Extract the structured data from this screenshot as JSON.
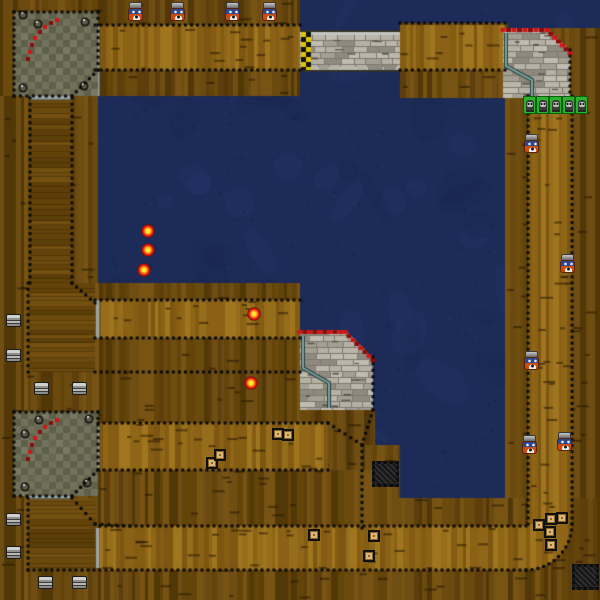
{
  "canvas": {
    "width": 600,
    "height": 600
  },
  "palette": {
    "water_base": "#1d2b58",
    "water_light": "#2c3e74",
    "water_dark": "#16224a",
    "water_speckle": "#121c3c",
    "wood_outer": [
      "#6b4a10",
      "#5e3f0b",
      "#775414",
      "#523807",
      "#6f4e13",
      "#634409"
    ],
    "wood_lane": [
      "#8a6115",
      "#966d1b",
      "#7d5711",
      "#a0751f",
      "#8f6617",
      "#845c12"
    ],
    "wood_block": [
      "#6b4a0e",
      "#634309",
      "#734f10",
      "#5c3e08"
    ],
    "plank_seam": "rgba(35,22,4,0.55)",
    "checker_a": "#71725b",
    "checker_b": "#5f604a",
    "stone_shades": [
      "#b5b1a5",
      "#c0bcb0",
      "#a39f93",
      "#8e8a7f",
      "#bab6aa"
    ],
    "mortar": "#7d796e",
    "stone_dash": "#5a564c",
    "curb_red": "#d11616",
    "curb_dark": "#8c0c0c",
    "rail_teal": "#7fa09e",
    "rail_teal_dark": "#24403d",
    "rail_gray": "#c2c6c0",
    "rail_gray_dark": "#30302a",
    "gray_strip": "#9ba3a3",
    "gray_strip_edge": "#5f6a6a",
    "dotted": "#0b0b0b",
    "start_yellow": "#dfc400",
    "start_black": "#121212",
    "bolt_dark": "#17170f",
    "bolt_mid": "#5d5d4f",
    "bolt_light": "#d3d3c7"
  },
  "terrain": {
    "wood_outer": [
      [
        0,
        0,
        300,
        96
      ],
      [
        400,
        23,
        108,
        75
      ],
      [
        505,
        28,
        95,
        572
      ],
      [
        0,
        96,
        98,
        504
      ],
      [
        75,
        283,
        225,
        190
      ],
      [
        300,
        410,
        75,
        118
      ],
      [
        362,
        445,
        38,
        53
      ],
      [
        98,
        470,
        300,
        130
      ],
      [
        398,
        498,
        202,
        102
      ]
    ],
    "lanes": [
      [
        95,
        25,
        205,
        45
      ],
      [
        400,
        25,
        105,
        45
      ],
      [
        528,
        96,
        44,
        434
      ],
      [
        100,
        526,
        428,
        44
      ],
      [
        95,
        300,
        205,
        38
      ],
      [
        98,
        423,
        230,
        47
      ]
    ],
    "corner_disc": {
      "cx": 526,
      "cy": 524,
      "r": 46
    },
    "blocks_h": [
      [
        30,
        98,
        42,
        185
      ],
      [
        28,
        283,
        67,
        89
      ],
      [
        28,
        498,
        67,
        70
      ]
    ],
    "gray_strips": [
      [
        95,
        24,
        5,
        72
      ],
      [
        30,
        95,
        42,
        5
      ],
      [
        95,
        424,
        5,
        44
      ],
      [
        28,
        495,
        44,
        4
      ],
      [
        96,
        528,
        4,
        40
      ],
      [
        96,
        300,
        4,
        38
      ]
    ],
    "dotted": [
      [
        95,
        25,
        300,
        25
      ],
      [
        400,
        23,
        505,
        23
      ],
      [
        95,
        70,
        300,
        70
      ],
      [
        400,
        70,
        505,
        70
      ],
      [
        528,
        96,
        528,
        524
      ],
      [
        572,
        96,
        572,
        524
      ],
      [
        100,
        526,
        526,
        526
      ],
      [
        28,
        570,
        526,
        570
      ],
      [
        95,
        300,
        300,
        300
      ],
      [
        95,
        338,
        300,
        338
      ],
      [
        95,
        372,
        300,
        372
      ],
      [
        98,
        423,
        328,
        423
      ],
      [
        98,
        470,
        328,
        470
      ],
      [
        328,
        423,
        362,
        445
      ],
      [
        362,
        445,
        362,
        528
      ],
      [
        373,
        410,
        362,
        445
      ],
      [
        373,
        357,
        373,
        410
      ],
      [
        570,
        50,
        570,
        98
      ],
      [
        30,
        98,
        30,
        283
      ],
      [
        72,
        98,
        72,
        283
      ],
      [
        28,
        283,
        28,
        372
      ],
      [
        72,
        283,
        95,
        303
      ],
      [
        28,
        498,
        28,
        570
      ],
      [
        72,
        498,
        95,
        524
      ],
      [
        95,
        524,
        130,
        526
      ],
      [
        14,
        12,
        98,
        12
      ],
      [
        98,
        12,
        98,
        70
      ],
      [
        98,
        70,
        72,
        96
      ],
      [
        14,
        96,
        72,
        96
      ],
      [
        14,
        12,
        14,
        96
      ],
      [
        14,
        412,
        98,
        412
      ],
      [
        98,
        412,
        98,
        470
      ],
      [
        98,
        470,
        72,
        496
      ],
      [
        14,
        496,
        72,
        496
      ],
      [
        14,
        412,
        14,
        496
      ]
    ],
    "arcs": [
      [
        526,
        524,
        46,
        0,
        90
      ]
    ],
    "pits": [
      {
        "x": 14,
        "y": 12,
        "size": 84,
        "bolts": [
          [
            23,
            15
          ],
          [
            38,
            24
          ],
          [
            85,
            22
          ],
          [
            23,
            88
          ],
          [
            84,
            86
          ]
        ],
        "curb": [
          [
            55,
            18
          ],
          [
            49,
            21
          ],
          [
            43,
            25
          ],
          [
            38,
            30
          ],
          [
            33,
            36
          ],
          [
            30,
            43
          ],
          [
            28,
            50
          ],
          [
            26,
            57
          ]
        ]
      },
      {
        "x": 14,
        "y": 412,
        "size": 84,
        "bolts": [
          [
            39,
            420
          ],
          [
            25,
            434
          ],
          [
            89,
            419
          ],
          [
            25,
            487
          ],
          [
            87,
            483
          ]
        ],
        "curb": [
          [
            55,
            418
          ],
          [
            49,
            421
          ],
          [
            43,
            425
          ],
          [
            38,
            430
          ],
          [
            33,
            436
          ],
          [
            30,
            443
          ],
          [
            28,
            450
          ],
          [
            26,
            457
          ]
        ]
      }
    ],
    "platforms": [
      {
        "poly": [
          [
            503,
            28
          ],
          [
            547,
            28
          ],
          [
            570,
            51
          ],
          [
            570,
            98
          ],
          [
            503,
            98
          ]
        ],
        "curbs": [
          [
            503,
            28,
            547,
            28
          ],
          [
            547,
            28,
            570,
            51
          ]
        ],
        "rail": [
          [
            506,
            33
          ],
          [
            506,
            66
          ],
          [
            532,
            80
          ],
          [
            532,
            97
          ]
        ]
      },
      {
        "poly": [
          [
            300,
            330
          ],
          [
            345,
            330
          ],
          [
            373,
            358
          ],
          [
            373,
            410
          ],
          [
            300,
            410
          ]
        ],
        "curbs": [
          [
            300,
            330,
            345,
            330
          ],
          [
            345,
            330,
            373,
            358
          ]
        ],
        "rail": [
          [
            303,
            336
          ],
          [
            303,
            368
          ],
          [
            329,
            383
          ],
          [
            329,
            408
          ]
        ]
      }
    ],
    "bridge": {
      "x": 300,
      "y": 30,
      "w": 100,
      "h": 42,
      "start_line": {
        "x": 301,
        "w": 10,
        "cell": 5
      }
    }
  },
  "objects": [
    {
      "type": "spectator",
      "name": "spectator-sprite",
      "x": 128,
      "y": 2
    },
    {
      "type": "spectator",
      "name": "spectator-sprite",
      "x": 170,
      "y": 2
    },
    {
      "type": "spectator",
      "name": "spectator-sprite",
      "x": 225,
      "y": 2
    },
    {
      "type": "spectator",
      "name": "spectator-sprite",
      "x": 262,
      "y": 2
    },
    {
      "type": "spectator",
      "name": "spectator-sprite",
      "x": 524,
      "y": 134
    },
    {
      "type": "spectator",
      "name": "spectator-sprite",
      "x": 560,
      "y": 254
    },
    {
      "type": "spectator",
      "name": "spectator-sprite",
      "x": 524,
      "y": 351
    },
    {
      "type": "spectator",
      "name": "spectator-sprite",
      "x": 522,
      "y": 435
    },
    {
      "type": "spectator",
      "name": "spectator-sprite",
      "x": 557,
      "y": 432
    },
    {
      "type": "creature",
      "name": "creature-sprite",
      "x": 523,
      "y": 96
    },
    {
      "type": "creature",
      "name": "creature-sprite",
      "x": 536,
      "y": 96
    },
    {
      "type": "creature",
      "name": "creature-sprite",
      "x": 549,
      "y": 96
    },
    {
      "type": "creature",
      "name": "creature-sprite",
      "x": 562,
      "y": 96
    },
    {
      "type": "creature",
      "name": "creature-sprite",
      "x": 575,
      "y": 96
    },
    {
      "type": "orb",
      "name": "item-orb",
      "x": 141,
      "y": 224
    },
    {
      "type": "orb",
      "name": "item-orb",
      "x": 141,
      "y": 243
    },
    {
      "type": "orb",
      "name": "item-orb",
      "x": 137,
      "y": 263
    },
    {
      "type": "orb",
      "name": "item-orb",
      "x": 247,
      "y": 307
    },
    {
      "type": "orb",
      "name": "item-orb",
      "x": 244,
      "y": 376
    },
    {
      "type": "crate",
      "name": "crate",
      "x": 206,
      "y": 457
    },
    {
      "type": "crate",
      "name": "crate",
      "x": 214,
      "y": 449
    },
    {
      "type": "crate",
      "name": "crate",
      "x": 272,
      "y": 428
    },
    {
      "type": "crate",
      "name": "crate",
      "x": 282,
      "y": 429
    },
    {
      "type": "crate",
      "name": "crate",
      "x": 308,
      "y": 529
    },
    {
      "type": "crate",
      "name": "crate",
      "x": 368,
      "y": 530
    },
    {
      "type": "crate",
      "name": "crate",
      "x": 363,
      "y": 550
    },
    {
      "type": "crate",
      "name": "crate",
      "x": 545,
      "y": 513
    },
    {
      "type": "crate",
      "name": "crate",
      "x": 556,
      "y": 512
    },
    {
      "type": "crate",
      "name": "crate",
      "x": 533,
      "y": 519
    },
    {
      "type": "crate",
      "name": "crate",
      "x": 544,
      "y": 526
    },
    {
      "type": "crate",
      "name": "crate",
      "x": 545,
      "y": 539
    },
    {
      "type": "barrel",
      "name": "barrel",
      "x": 6,
      "y": 314
    },
    {
      "type": "barrel",
      "name": "barrel",
      "x": 6,
      "y": 349
    },
    {
      "type": "barrel",
      "name": "barrel",
      "x": 34,
      "y": 382
    },
    {
      "type": "barrel",
      "name": "barrel",
      "x": 72,
      "y": 382
    },
    {
      "type": "barrel",
      "name": "barrel",
      "x": 6,
      "y": 513
    },
    {
      "type": "barrel",
      "name": "barrel",
      "x": 6,
      "y": 546
    },
    {
      "type": "barrel",
      "name": "barrel",
      "x": 38,
      "y": 576
    },
    {
      "type": "barrel",
      "name": "barrel",
      "x": 72,
      "y": 576
    },
    {
      "type": "grate",
      "name": "drain-grate",
      "x": 372,
      "y": 461
    },
    {
      "type": "grate",
      "name": "drain-grate",
      "x": 572,
      "y": 564
    }
  ]
}
